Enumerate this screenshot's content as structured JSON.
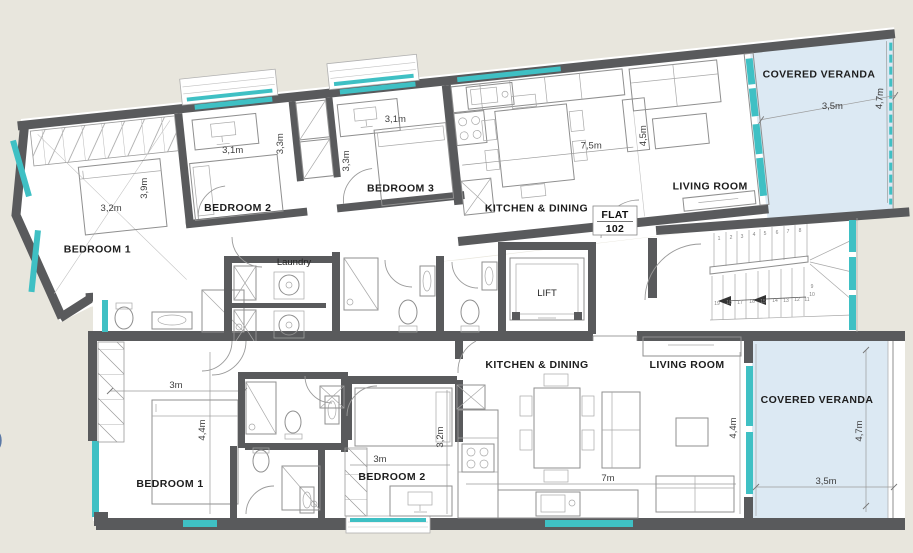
{
  "palette": {
    "background": "#e8e6dd",
    "wall": "#595a5c",
    "window_teal": "#3fc0c4",
    "veranda_fill": "#dce9f3",
    "furniture_line": "#8f8f8f",
    "label_text": "#1d1d1d",
    "dim_text": "#3f3f3f"
  },
  "stray_mark": ")",
  "flat_102": {
    "badge": {
      "line1": "FLAT",
      "line2": "102"
    },
    "laundry_label": "Laundry",
    "rooms": {
      "bedroom1": {
        "label": "BEDROOM 1",
        "dim_w": "3,2m",
        "dim_h": "3,9m"
      },
      "bedroom2": {
        "label": "BEDROOM 2",
        "dim_w": "3,1m",
        "dim_h": "3,3m"
      },
      "bedroom3": {
        "label": "BEDROOM 3",
        "dim_w": "3,1m",
        "dim_h": "3,3m"
      },
      "kitchen_dining": {
        "label": "KITCHEN & DINING",
        "dim": "7,5m"
      },
      "living_room": {
        "label": "LIVING ROOM",
        "dim": "4,5m"
      },
      "covered_veranda": {
        "label": "COVERED VERANDA",
        "dim_w": "3,5m",
        "dim_h": "4,7m"
      }
    }
  },
  "flat_101": {
    "badge": {
      "line1": "FLAT",
      "line2": "101"
    },
    "laundry_label": "Laundry",
    "rooms": {
      "bedroom1": {
        "label": "BEDROOM 1",
        "dim_w": "3m",
        "dim_h": "4,4m"
      },
      "bedroom2": {
        "label": "BEDROOM 2",
        "dim_w": "3m",
        "dim_h": "3,2m"
      },
      "kitchen_dining": {
        "label": "KITCHEN & DINING",
        "dim": "7m"
      },
      "living_room": {
        "label": "LIVING ROOM",
        "dim": "4,4m"
      },
      "covered_veranda": {
        "label": "COVERED VERANDA",
        "dim_w": "3,5m",
        "dim_h": "4,7m"
      }
    }
  },
  "core": {
    "lift_label": "LIFT",
    "stairs": {
      "up": [
        "1",
        "2",
        "3",
        "4",
        "5",
        "6",
        "7",
        "8"
      ],
      "mid": [
        "9",
        "10"
      ],
      "down": [
        "19",
        "18",
        "17",
        "16",
        "15",
        "14",
        "13",
        "12",
        "11"
      ]
    }
  }
}
